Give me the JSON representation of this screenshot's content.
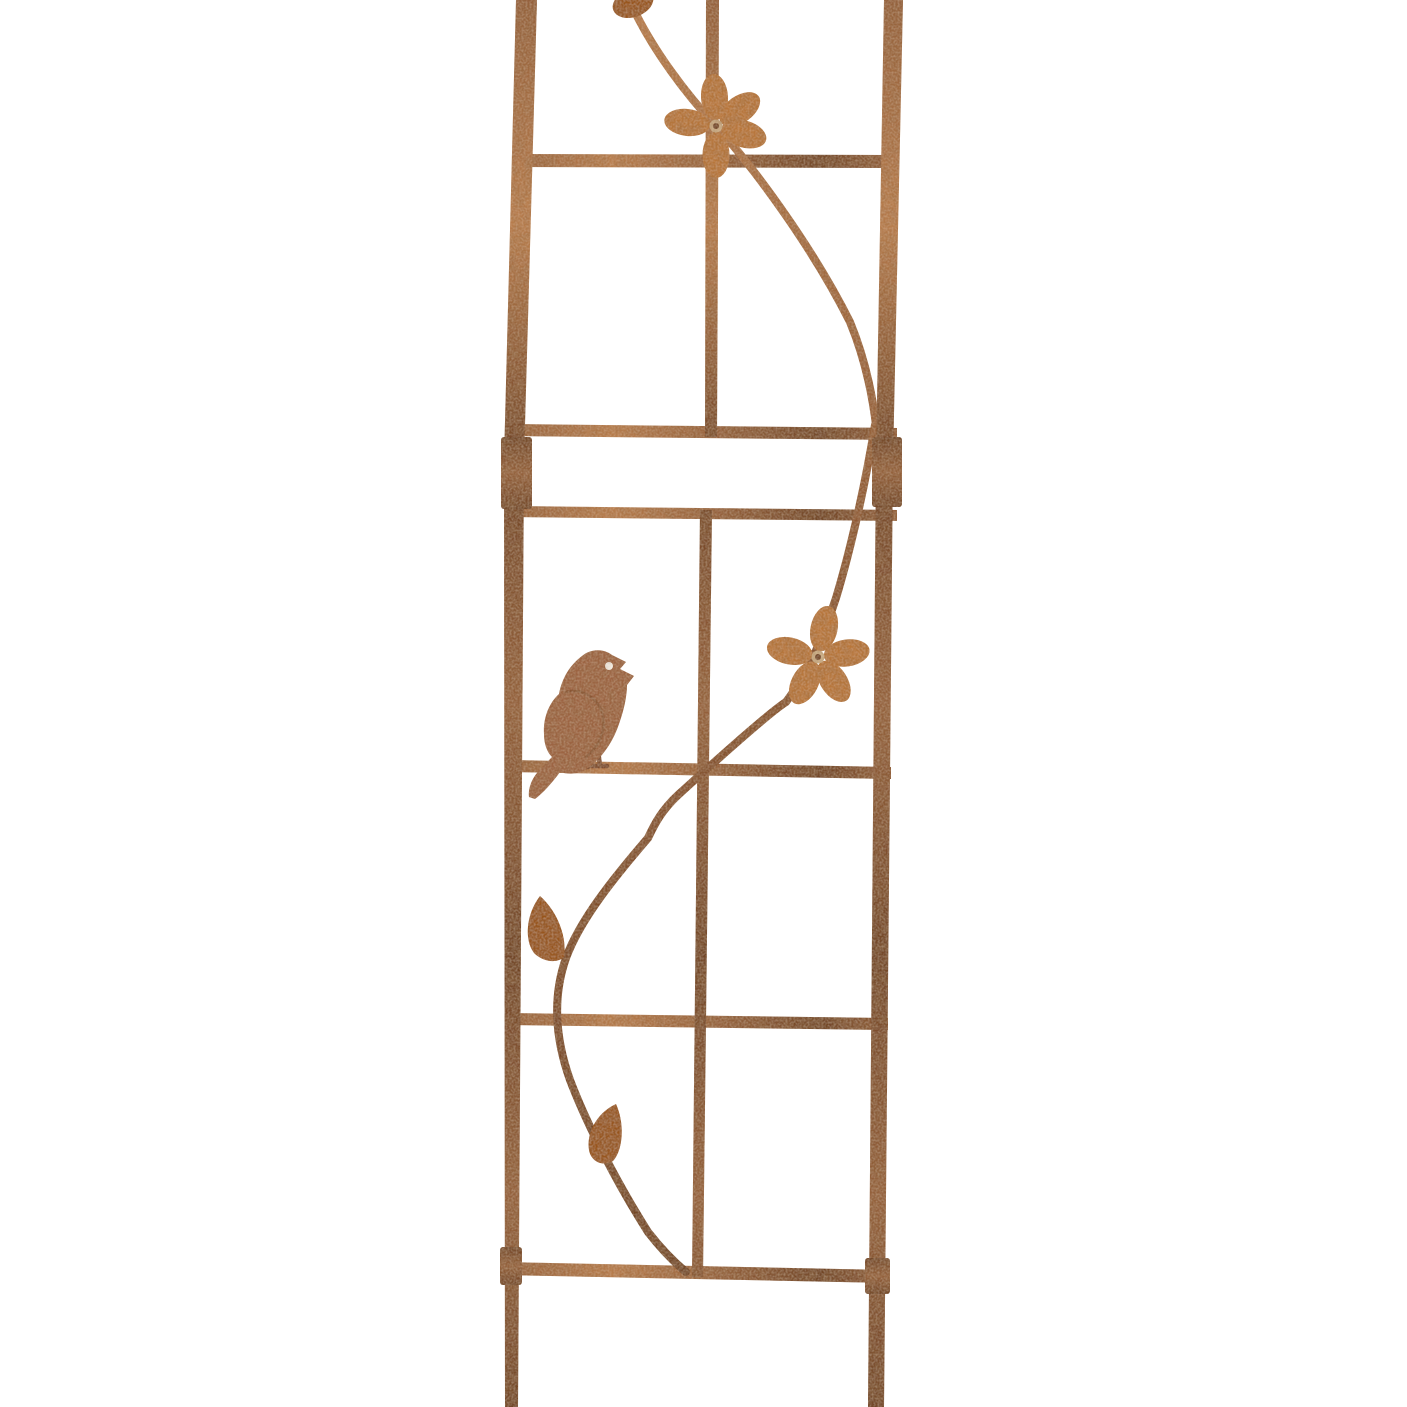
{
  "page": {
    "background_color": "#ffffff",
    "description": "Rusted metal garden trellis panel decorated with a curving vine, two five-petal flowers, two leaves and a singing bird silhouette perched on a crossbar"
  },
  "colors": {
    "rust_dark": "#6f4326",
    "rust_mid": "#95613c",
    "rust_light": "#b97e4e",
    "rust_pale": "#cf9a66",
    "vine": "#8a5531",
    "flower": "#b9773a",
    "flower_hub": "#c9ac85",
    "flower_pin": "#6f4326",
    "leaf": "#98551f",
    "bird_body": "#9c6442",
    "bird_detail": "#7c4a2e",
    "bird_eye": "#f7f3ea"
  }
}
